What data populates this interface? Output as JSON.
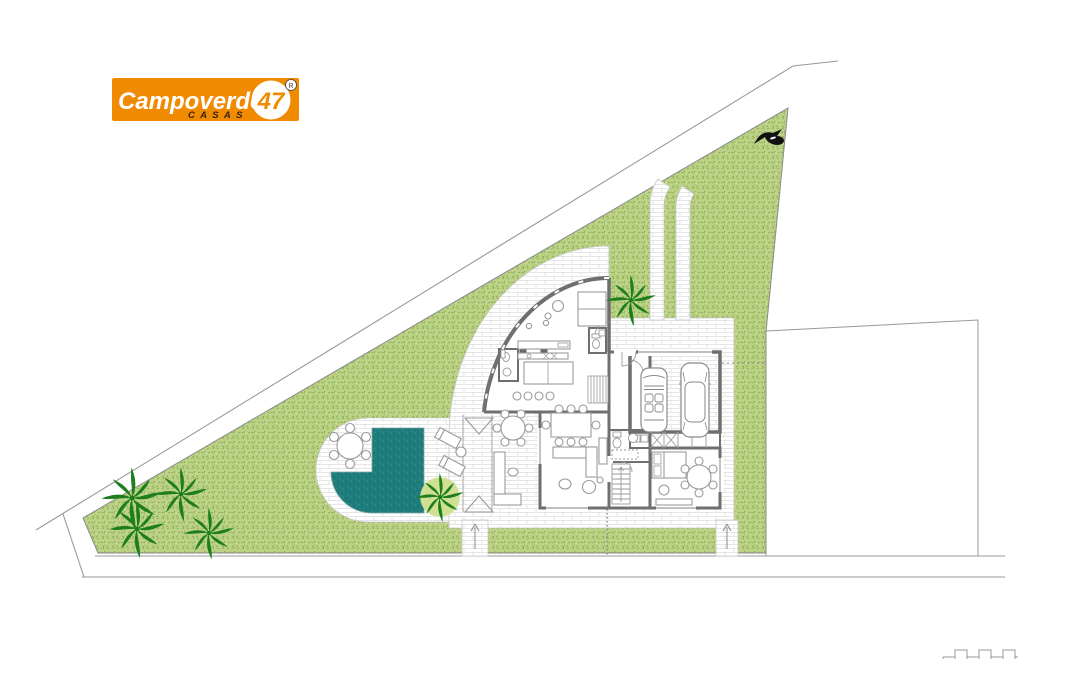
{
  "page": {
    "background": "#ffffff"
  },
  "logo": {
    "brand": "Campoverde",
    "sub_label": "C A S A S",
    "badge_number": "47",
    "registered_mark": "R",
    "bg_color": "#F08A00",
    "brand_color": "#FFFFFF",
    "sub_color": "#332211",
    "badge_bg": "#FFFFFF",
    "badge_text_color": "#F08A00"
  },
  "colors": {
    "garden_base": "#bcd287",
    "garden_blade_dark": "#87a94c",
    "garden_blade_mid": "#9fbd62",
    "pool_teal": "#1f7e7c",
    "pool_dot_dark": "#186a68",
    "pool_dot_light": "#2f918f",
    "palm_green": "#1e7d1e",
    "palm_bed": "#cfe093",
    "wall_gray": "#6f6f6f",
    "line_gray": "#999999",
    "paving_joint": "#dedede",
    "furniture_gray": "#9a9a9a",
    "bird_black": "#111111"
  },
  "landscape": {
    "palms": [
      {
        "x": 132,
        "y": 498,
        "scale": 1.15,
        "bed": false
      },
      {
        "x": 181,
        "y": 494,
        "scale": 1.0,
        "bed": false
      },
      {
        "x": 137,
        "y": 529,
        "scale": 1.05,
        "bed": false
      },
      {
        "x": 209,
        "y": 533,
        "scale": 0.95,
        "bed": false
      },
      {
        "x": 440,
        "y": 497,
        "scale": 0.9,
        "bed": true
      },
      {
        "x": 631,
        "y": 300,
        "scale": 0.95,
        "bed": false
      }
    ]
  },
  "vehicles": [
    {
      "type": "convertible",
      "x": 654,
      "y": 400
    },
    {
      "type": "sedan",
      "x": 695,
      "y": 400
    }
  ]
}
